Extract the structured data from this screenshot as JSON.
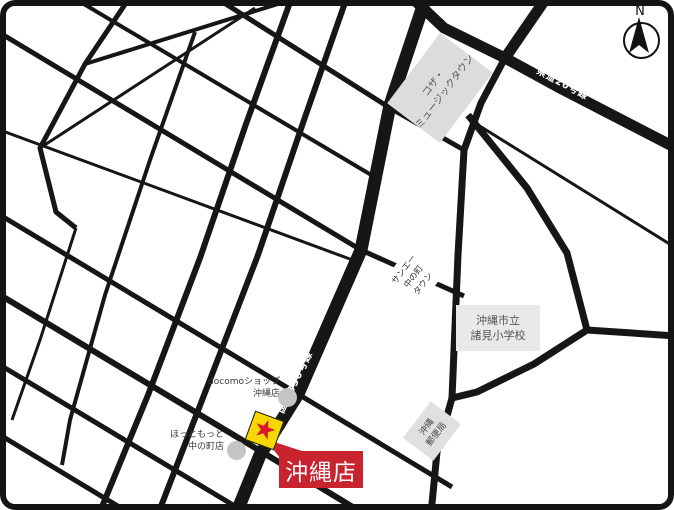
{
  "map": {
    "compass_label": "N",
    "road_labels": {
      "route330": "国道330号線",
      "route20": "県道20号線"
    },
    "places": {
      "koza_music_town": {
        "line1": "コザ・",
        "line2": "ミュージックタウン"
      },
      "school": {
        "line1": "沖縄市立",
        "line2": "諸見小学校"
      },
      "sanei_town": {
        "line1": "サンエー",
        "line2": "中の町",
        "line3": "タウン"
      },
      "post_office": {
        "line1": "沖縄",
        "line2": "郵便局"
      },
      "docomo_shop": {
        "line1": "docomoショップ",
        "line2": "沖縄店"
      },
      "hottomotto": {
        "line1": "ほっともっと",
        "line2": "中の町店"
      }
    },
    "store_callout": {
      "label": "沖縄店"
    },
    "marker": {
      "glyph": "★"
    },
    "colors": {
      "road": "#161616",
      "area_fill": "#dcdcdc",
      "school_fill": "#e9e9e9",
      "poi_circle": "#c5c5c5",
      "marker_yellow": "#f6d800",
      "marker_star_red": "#d7182f",
      "callout_red": "#c8232e",
      "label_text": "#4a4a4a"
    }
  }
}
